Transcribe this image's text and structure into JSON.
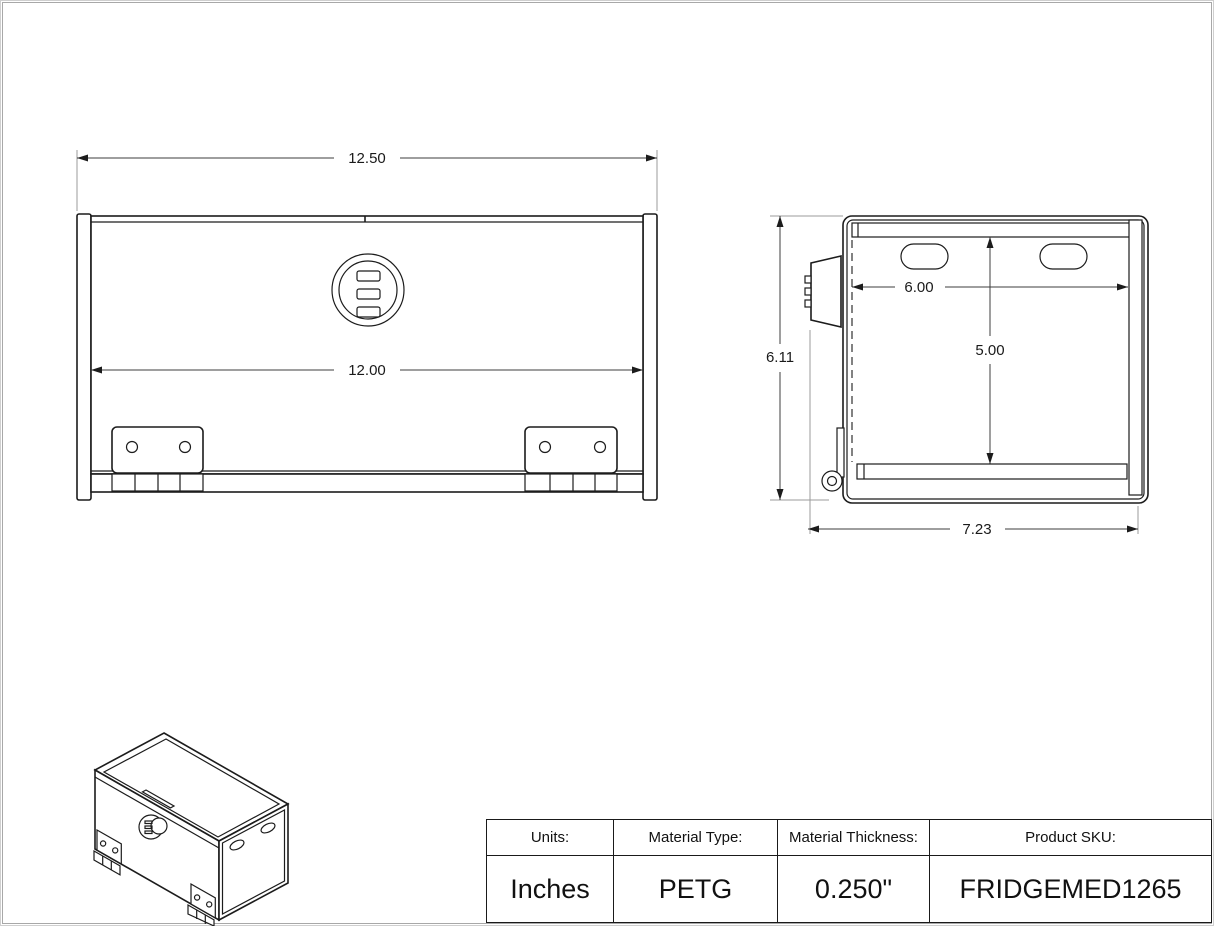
{
  "drawing": {
    "front_view": {
      "dim_overall_width": "12.50",
      "dim_inner_width": "12.00"
    },
    "side_view": {
      "dim_height": "6.11",
      "dim_top_width": "6.00",
      "dim_inner_height": "5.00",
      "dim_depth": "7.23"
    }
  },
  "title_block": {
    "columns": [
      {
        "label": "Units:",
        "value": "Inches"
      },
      {
        "label": "Material Type:",
        "value": "PETG"
      },
      {
        "label": "Material Thickness:",
        "value": "0.250\""
      },
      {
        "label": "Product SKU:",
        "value": "FRIDGEMED1265"
      }
    ]
  }
}
